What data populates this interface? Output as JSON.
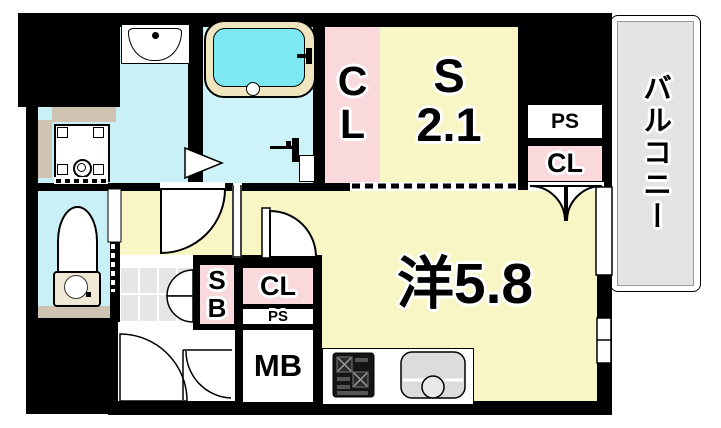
{
  "title": "apartment-floor-plan",
  "labels": {
    "main_room": "洋5.8",
    "service_room_line1": "S",
    "service_room_line2": "2.1",
    "closet_top_line1": "C",
    "closet_top_line2": "L",
    "ps_top_right": "PS",
    "closet_top_right": "CL",
    "shoe_box_line1": "S",
    "shoe_box_line2": "B",
    "closet_center": "CL",
    "ps_center": "PS",
    "meter_box": "MB",
    "balcony": "バルコニー"
  },
  "rooms": [
    {
      "name": "western-room",
      "label": "洋5.8"
    },
    {
      "name": "service-room",
      "label": "S 2.1"
    },
    {
      "name": "balcony",
      "label": "バルコニー"
    },
    {
      "name": "closet-top",
      "label": "CL"
    },
    {
      "name": "closet-right",
      "label": "CL"
    },
    {
      "name": "closet-center",
      "label": "CL"
    },
    {
      "name": "pipe-space-right",
      "label": "PS"
    },
    {
      "name": "pipe-space-center",
      "label": "PS"
    },
    {
      "name": "shoe-box",
      "label": "SB"
    },
    {
      "name": "meter-box",
      "label": "MB"
    }
  ],
  "fixtures": [
    "wash-basin",
    "bathtub",
    "shower-faucet",
    "washing-machine-pan",
    "toilet",
    "entrance-tile",
    "kitchen-stove",
    "kitchen-sink"
  ],
  "colors": {
    "room_yellow": "#F9F6C6",
    "closet_pink": "#F9D9DC",
    "water_cyan": "#C9F0F7",
    "bath_cyan": "#CDF2F7",
    "tub_cyan": "#7DE8F1",
    "tub_rim_cream": "#EFE6C0",
    "counter_tan": "#CFC4B1",
    "balcony_gray": "#E4E4E4",
    "tile_gray": "#E6E6E6",
    "wall_black": "#000000"
  }
}
